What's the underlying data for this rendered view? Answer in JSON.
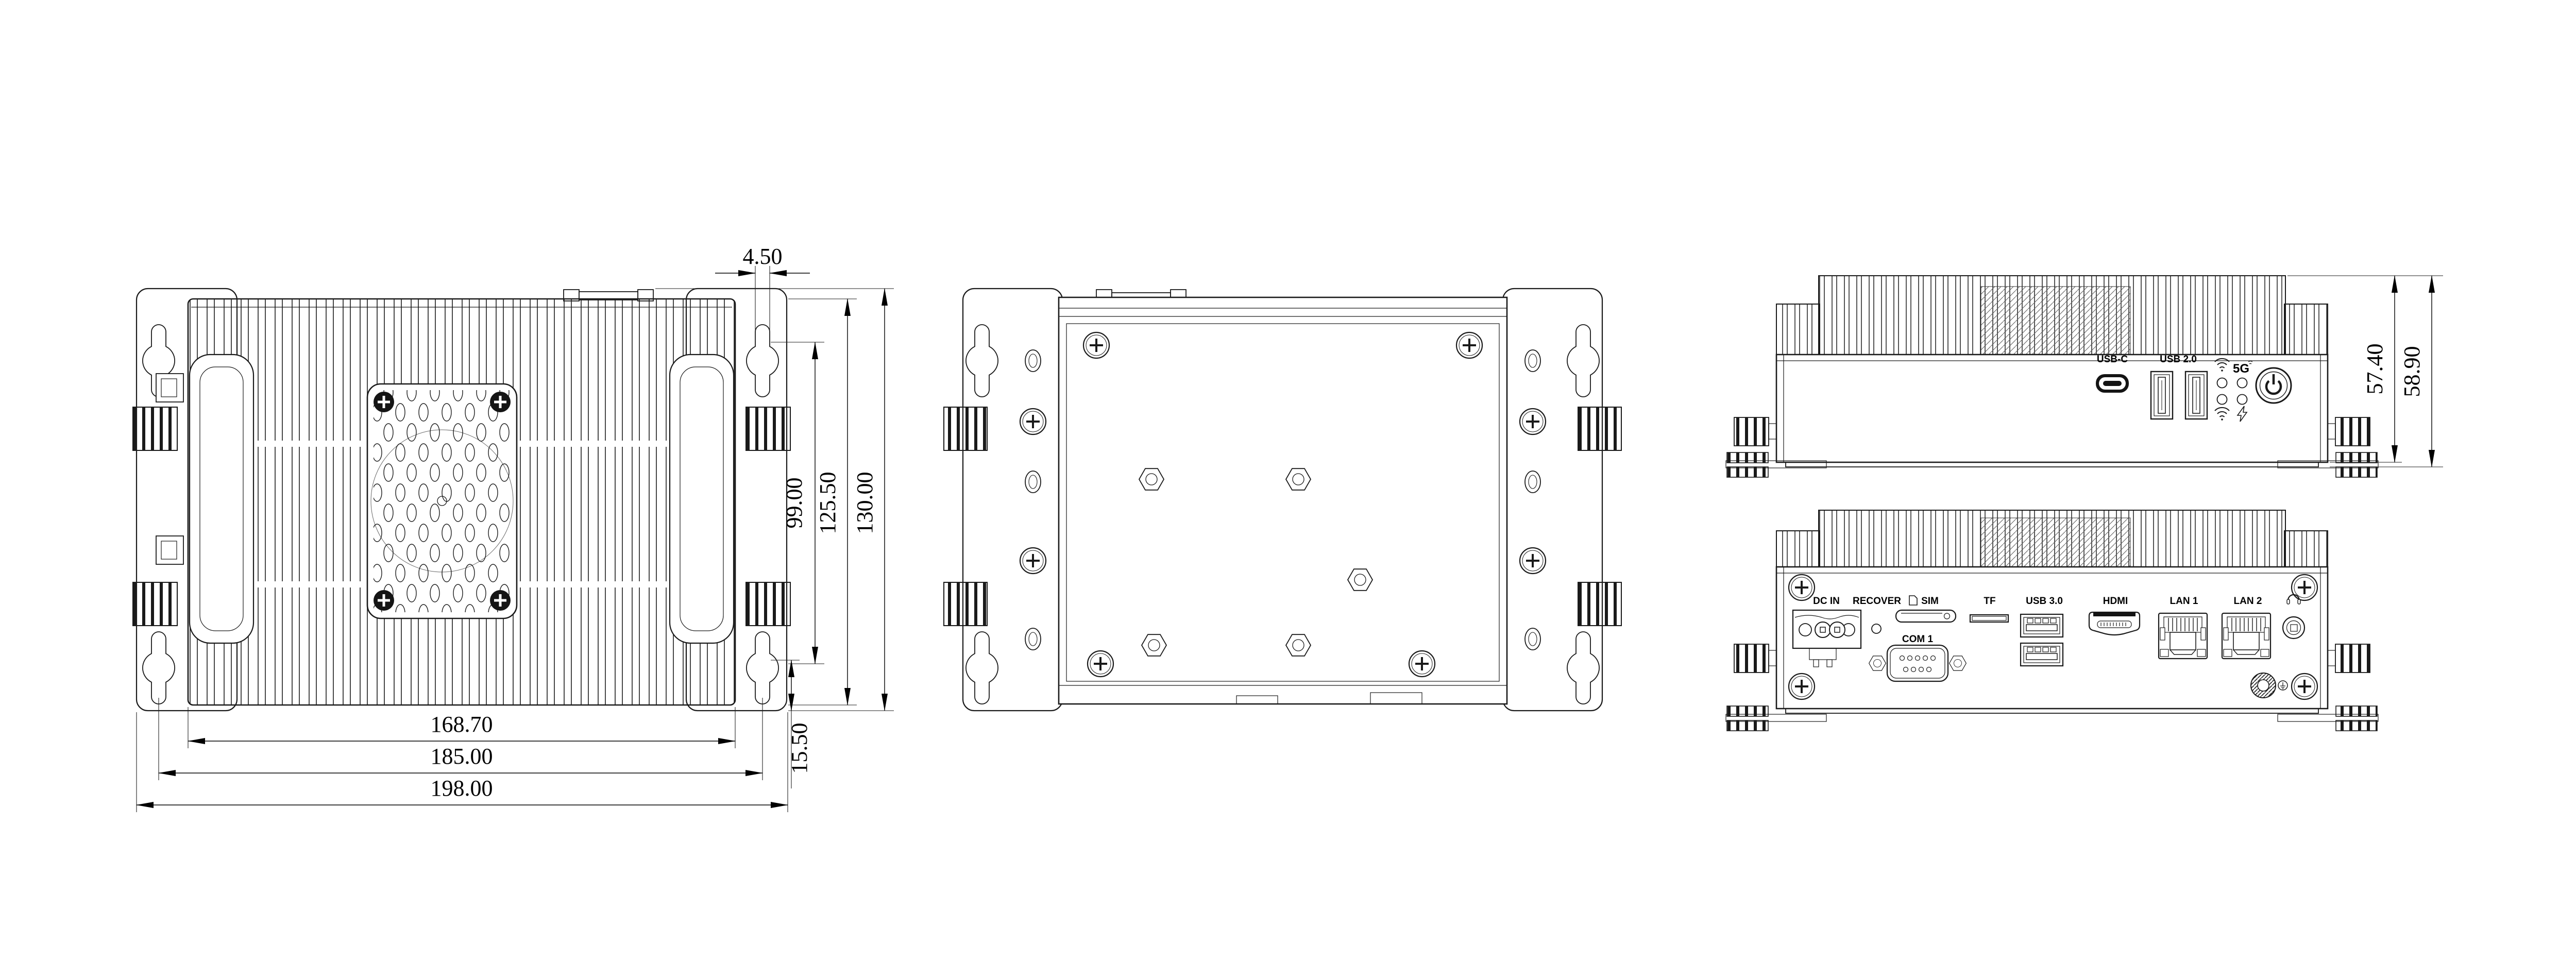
{
  "top_view": {
    "dims": {
      "slot_width": "4.50",
      "mount_span_v": "99.00",
      "body_height": "125.50",
      "overall_height": "130.00",
      "fin_width": "168.70",
      "mount_span_h": "185.00",
      "overall_width": "198.00",
      "mount_offset": "15.50"
    }
  },
  "front_view": {
    "ports": {
      "usb_c": "USB-C",
      "usb_2_0": "USB 2.0"
    },
    "leds": {
      "cell": "5G"
    },
    "dims": {
      "body_height": "57.40",
      "overall_height": "58.90"
    }
  },
  "rear_view": {
    "ports": {
      "dc_in": "DC IN",
      "recover": "RECOVER",
      "sim": "SIM",
      "com_1": "COM 1",
      "tf": "TF",
      "usb_3_0": "USB 3.0",
      "hdmi": "HDMI",
      "lan_1": "LAN 1",
      "lan_2": "LAN 2"
    }
  }
}
